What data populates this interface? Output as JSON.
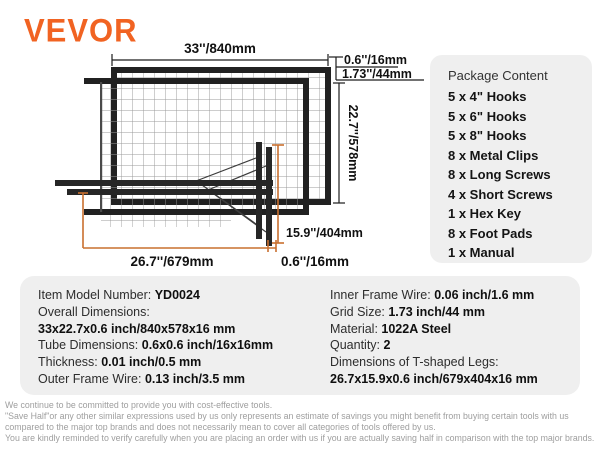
{
  "brand": {
    "logo_text": "VEVOR"
  },
  "colors": {
    "accent_orange": "#f16322",
    "dimension_line_orange": "#c9702f",
    "panel_background": "#efefef",
    "frame_black": "#212121"
  },
  "diagram": {
    "labels": {
      "width_top": "33''/840mm",
      "tube_top": "0.6''/16mm",
      "grid_cell": "1.73''/44mm",
      "height_right": "22.7''/578mm",
      "leg_height": "15.9''/404mm",
      "leg_length": "26.7''/679mm",
      "tube_bottom": "0.6''/16mm"
    }
  },
  "package_content": {
    "title": "Package Content",
    "items": [
      "5 x 4\" Hooks",
      "5 x 6\" Hooks",
      "5 x 8\" Hooks",
      "8 x Metal Clips",
      "8 x Long Screws",
      "4 x Short Screws",
      "1 x Hex Key",
      "8 x Foot Pads",
      "1 x Manual"
    ]
  },
  "specs": {
    "left": [
      {
        "label": "Item Model Number: ",
        "value": "YD0024"
      },
      {
        "label": "Overall Dimensions:",
        "value": ""
      },
      {
        "label": "",
        "value": "33x22.7x0.6 inch/840x578x16 mm"
      },
      {
        "label": "Tube Dimensions: ",
        "value": "0.6x0.6 inch/16x16mm"
      },
      {
        "label": "Thickness: ",
        "value": "0.01 inch/0.5 mm"
      },
      {
        "label": "Outer Frame Wire: ",
        "value": "0.13 inch/3.5 mm"
      }
    ],
    "right": [
      {
        "label": "Inner Frame Wire: ",
        "value": "0.06 inch/1.6 mm"
      },
      {
        "label": "Grid Size: ",
        "value": "1.73 inch/44 mm"
      },
      {
        "label": "Material: ",
        "value": "1022A Steel"
      },
      {
        "label": "Quantity: ",
        "value": "2"
      },
      {
        "label": "Dimensions of T-shaped Legs:",
        "value": ""
      },
      {
        "label": "",
        "value": "26.7x15.9x0.6 inch/679x404x16 mm"
      }
    ]
  },
  "footer": {
    "lines": [
      "We continue to be committed to provide you with cost-effective tools.",
      "\"Save Half\"or any other similar expressions used by us only represents an estimate of savings you might benefit from buying certain tools with us",
      "compared to the major top brands and does not necessarily mean to cover all categories of tools offered by us.",
      "You are kindly reminded to verify carefully when you are placing an order with us if you are actually saving half in comparison with the top major brands."
    ]
  }
}
